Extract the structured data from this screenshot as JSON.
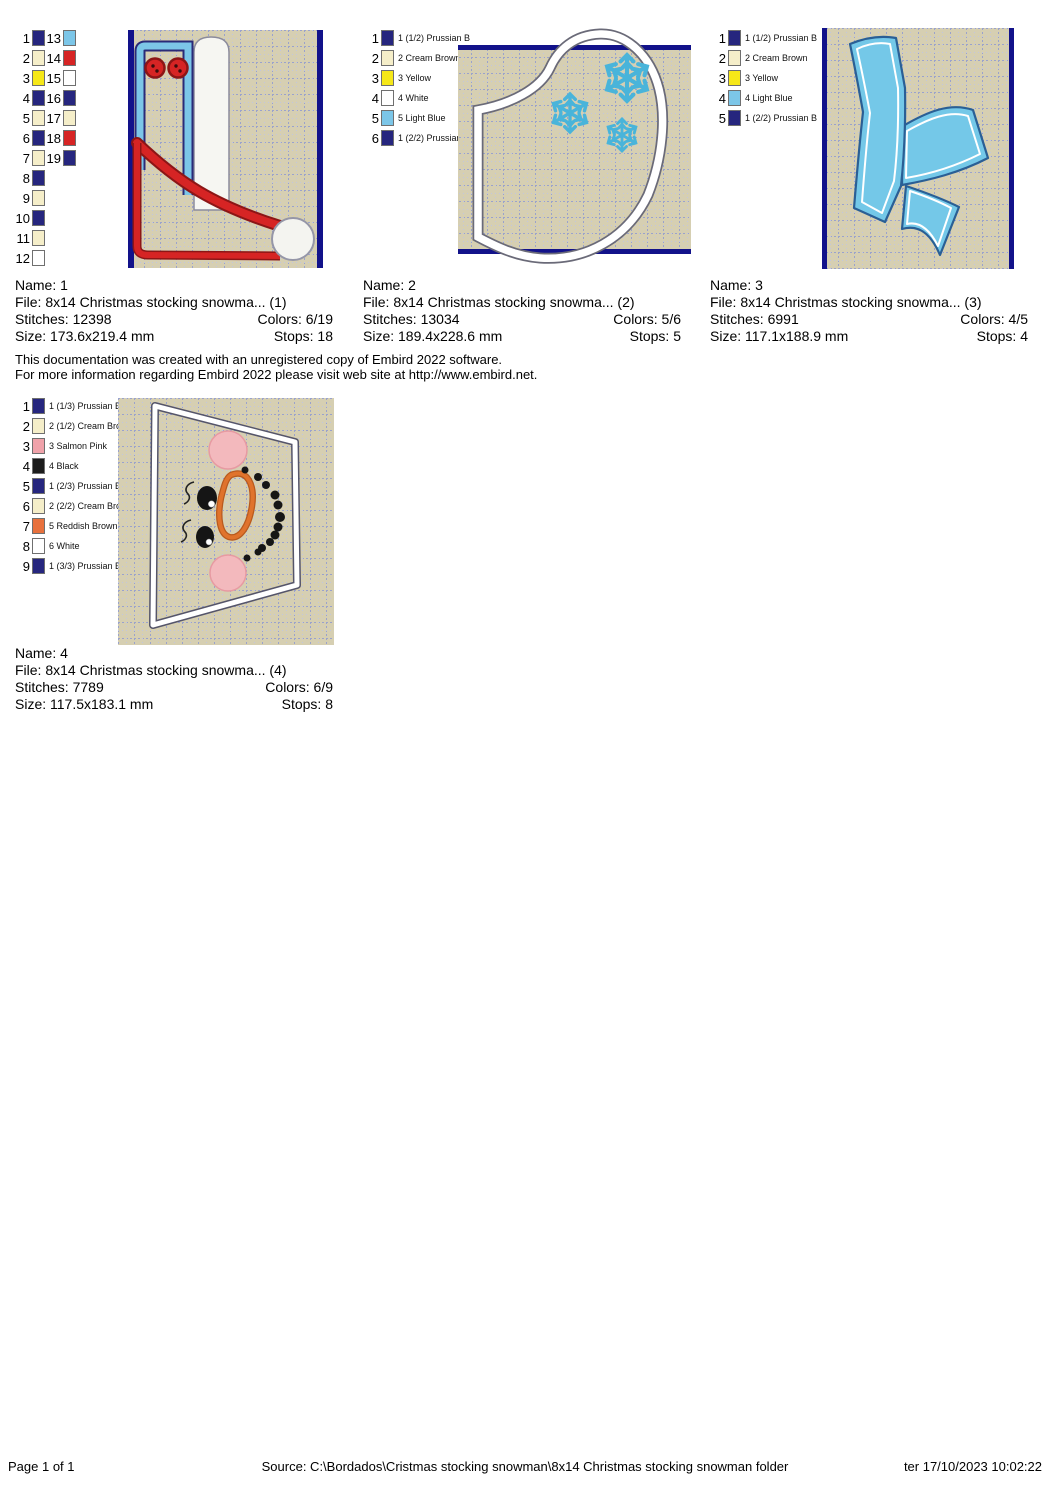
{
  "colors": {
    "navy": "#26267e",
    "navy_bar": "#12128a",
    "cream": "#f5eec9",
    "yellow": "#f6e818",
    "white": "#ffffff",
    "light_blue": "#7cc6e8",
    "red": "#d62424",
    "red_dark": "#8c1616",
    "salmon_pink": "#f0a2aa",
    "black_thread": "#1c1c1c",
    "reddish_brown": "#e8713d",
    "tan": "#d6cfb2",
    "grid_major": "#9aa2cc",
    "grid_minor": "#c2c6de",
    "outline_gray": "#6a6a78",
    "snow_blue": "#49b4da",
    "scarf_blue": "#74c8e8",
    "scarf_edge": "#2a5f95",
    "nose_orange": "#e0732c",
    "cheek_pink": "#f3b9bd"
  },
  "designs": [
    {
      "name_line": "Name: 1",
      "file_line": "File: 8x14 Christmas stocking snowma... (1)",
      "stitches_line": "Stitches: 12398",
      "colors_line": "Colors: 6/19",
      "size_line": "Size: 173.6x219.4 mm",
      "stops_line": "Stops: 18",
      "palette_left": [
        {
          "num": "1",
          "hex": "#26267e",
          "label": ""
        },
        {
          "num": "2",
          "hex": "#f5eec9",
          "label": ""
        },
        {
          "num": "3",
          "hex": "#f6e818",
          "label": ""
        },
        {
          "num": "4",
          "hex": "#26267e",
          "label": ""
        },
        {
          "num": "5",
          "hex": "#f5eec9",
          "label": ""
        },
        {
          "num": "6",
          "hex": "#26267e",
          "label": ""
        },
        {
          "num": "7",
          "hex": "#f5eec9",
          "label": ""
        },
        {
          "num": "8",
          "hex": "#26267e",
          "label": ""
        },
        {
          "num": "9",
          "hex": "#f5eec9",
          "label": ""
        },
        {
          "num": "10",
          "hex": "#26267e",
          "label": ""
        },
        {
          "num": "11",
          "hex": "#f5eec9",
          "label": ""
        },
        {
          "num": "12",
          "hex": "#ffffff",
          "label": ""
        }
      ],
      "palette_right": [
        {
          "num": "13",
          "hex": "#7cc6e8",
          "label": ""
        },
        {
          "num": "14",
          "hex": "#d62424",
          "label": ""
        },
        {
          "num": "15",
          "hex": "#ffffff",
          "label": ""
        },
        {
          "num": "16",
          "hex": "#26267e",
          "label": ""
        },
        {
          "num": "17",
          "hex": "#f5eec9",
          "label": ""
        },
        {
          "num": "18",
          "hex": "#d62424",
          "label": ""
        },
        {
          "num": "19",
          "hex": "#26267e",
          "label": ""
        }
      ]
    },
    {
      "name_line": "Name: 2",
      "file_line": "File: 8x14 Christmas stocking snowma... (2)",
      "stitches_line": "Stitches: 13034",
      "colors_line": "Colors: 5/6",
      "size_line": "Size: 189.4x228.6 mm",
      "stops_line": "Stops: 5",
      "palette": [
        {
          "num": "1",
          "hex": "#26267e",
          "label": "1 (1/2) Prussian B"
        },
        {
          "num": "2",
          "hex": "#f5eec9",
          "label": "2 Cream Brown"
        },
        {
          "num": "3",
          "hex": "#f6e818",
          "label": "3 Yellow"
        },
        {
          "num": "4",
          "hex": "#ffffff",
          "label": "4 White"
        },
        {
          "num": "5",
          "hex": "#7cc6e8",
          "label": "5 Light Blue"
        },
        {
          "num": "6",
          "hex": "#26267e",
          "label": "1 (2/2) Prussian B"
        }
      ]
    },
    {
      "name_line": "Name: 3",
      "file_line": "File: 8x14 Christmas stocking snowma... (3)",
      "stitches_line": "Stitches: 6991",
      "colors_line": "Colors: 4/5",
      "size_line": "Size: 117.1x188.9 mm",
      "stops_line": "Stops: 4",
      "palette": [
        {
          "num": "1",
          "hex": "#26267e",
          "label": "1 (1/2) Prussian B"
        },
        {
          "num": "2",
          "hex": "#f5eec9",
          "label": "2 Cream Brown"
        },
        {
          "num": "3",
          "hex": "#f6e818",
          "label": "3 Yellow"
        },
        {
          "num": "4",
          "hex": "#7cc6e8",
          "label": "4 Light Blue"
        },
        {
          "num": "5",
          "hex": "#26267e",
          "label": "1 (2/2) Prussian B"
        }
      ]
    },
    {
      "name_line": "Name: 4",
      "file_line": "File: 8x14 Christmas stocking snowma... (4)",
      "stitches_line": "Stitches: 7789",
      "colors_line": "Colors: 6/9",
      "size_line": "Size: 117.5x183.1 mm",
      "stops_line": "Stops: 8",
      "palette": [
        {
          "num": "1",
          "hex": "#26267e",
          "label": "1 (1/3) Prussian B"
        },
        {
          "num": "2",
          "hex": "#f5eec9",
          "label": "2 (1/2) Cream Bro"
        },
        {
          "num": "3",
          "hex": "#f0a2aa",
          "label": "3 Salmon Pink"
        },
        {
          "num": "4",
          "hex": "#1c1c1c",
          "label": "4 Black"
        },
        {
          "num": "5",
          "hex": "#26267e",
          "label": "1 (2/3) Prussian B"
        },
        {
          "num": "6",
          "hex": "#f5eec9",
          "label": "2 (2/2) Cream Bro"
        },
        {
          "num": "7",
          "hex": "#e8713d",
          "label": "5 Reddish Brown"
        },
        {
          "num": "8",
          "hex": "#ffffff",
          "label": "6 White"
        },
        {
          "num": "9",
          "hex": "#26267e",
          "label": "1 (3/3) Prussian B"
        }
      ]
    }
  ],
  "disclaimer": {
    "line1": "This documentation was created with an unregistered copy of Embird 2022 software.",
    "line2": "For more information regarding Embird 2022 please visit web site at http://www.embird.net."
  },
  "footer": {
    "page": "Page 1 of 1",
    "source": "Source: C:\\Bordados\\Cristmas stocking snowman\\8x14 Christmas stocking snowman folder",
    "datetime": "ter 17/10/2023 10:02:22"
  }
}
